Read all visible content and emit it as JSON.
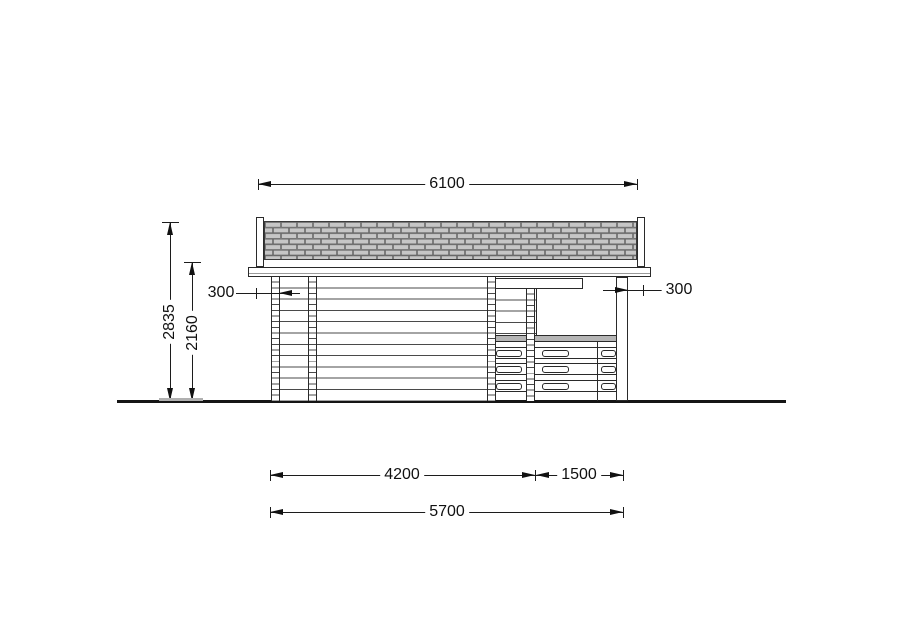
{
  "dims": {
    "roof_width": "6100",
    "total_height": "2835",
    "wall_height": "2160",
    "overhang_left": "300",
    "overhang_right": "300",
    "cabin_length": "4200",
    "terrace_length": "1500",
    "total_length": "5700"
  },
  "colors": {
    "background": "#ffffff",
    "line": "#2a2a2a",
    "shingle_fill": "#c6c6c6",
    "railing_band": "#b5b5b5",
    "dim_gray_bar": "#b0b0b0"
  }
}
